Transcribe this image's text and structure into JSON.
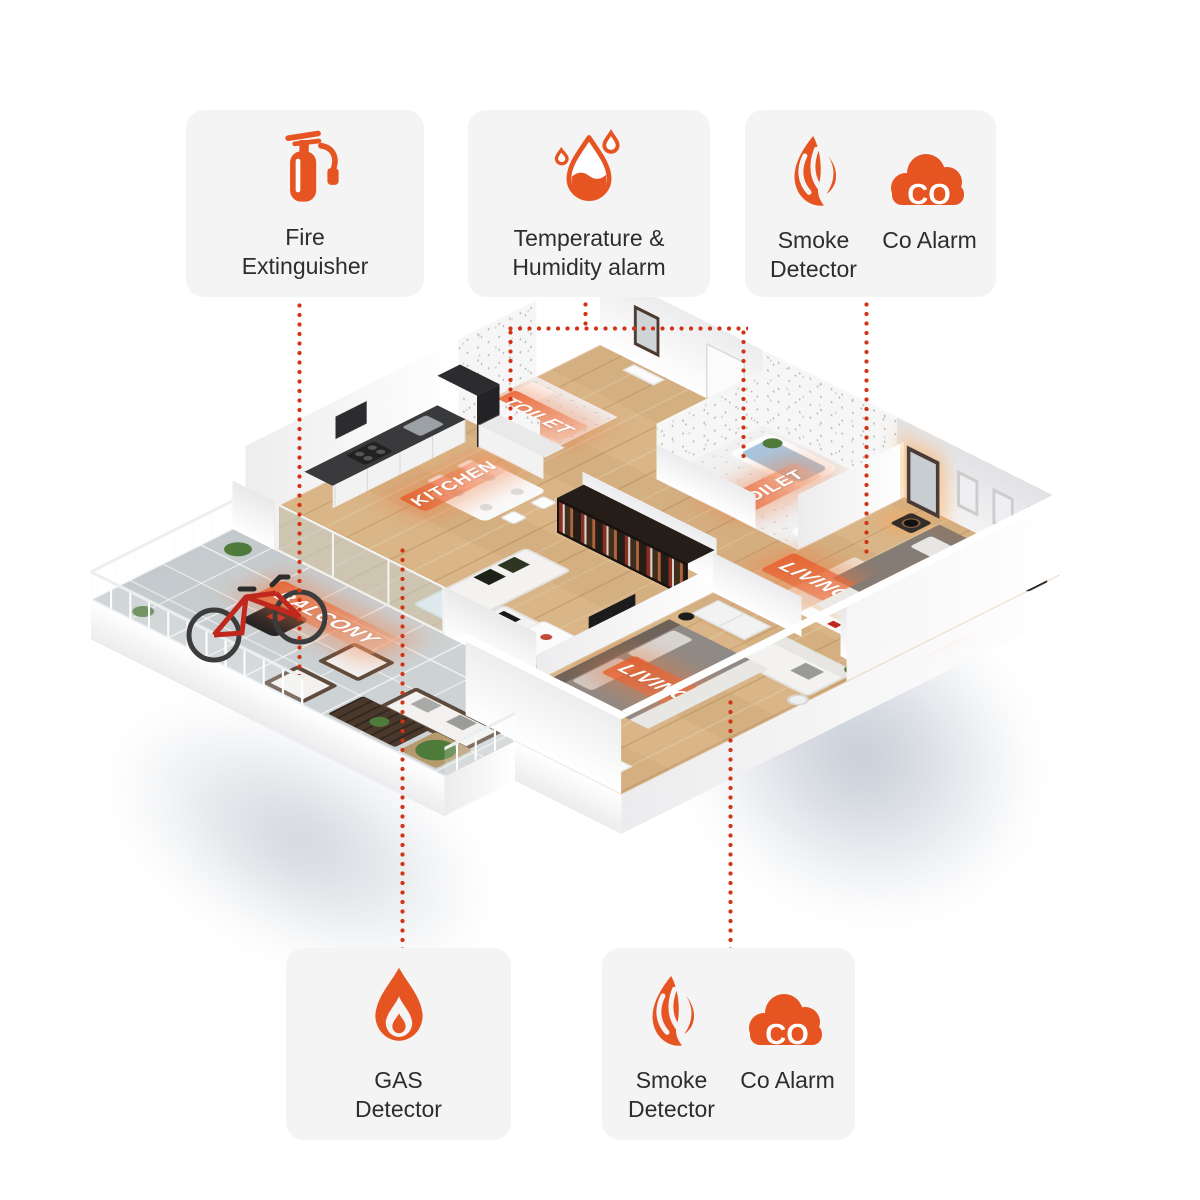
{
  "colors": {
    "accent": "#e65422",
    "dotted_line": "#d03415",
    "card_background": "#f4f4f4",
    "card_text": "#2d2d2d",
    "room_label_text": "#ffffff",
    "room_highlight": "#e8623a",
    "wood_floor": "#d9b587",
    "balcony_tile": "#cdd2d4"
  },
  "cards": {
    "fire": {
      "label": "Fire Extinguisher",
      "icon": "fire-extinguisher-icon"
    },
    "temp_humidity": {
      "label": "Temperature & Humidity alarm",
      "icon": "humidity-drop-icon"
    },
    "smoke_co_top": {
      "smoke_label": "Smoke Detector",
      "smoke_icon": "smoke-icon",
      "co_label": "Co Alarm",
      "co_icon": "co-cloud-icon",
      "co_badge": "CO"
    },
    "gas": {
      "label": "GAS Detector",
      "icon": "gas-flame-icon"
    },
    "smoke_co_bottom": {
      "smoke_label": "Smoke Detector",
      "smoke_icon": "smoke-icon",
      "co_label": "Co Alarm",
      "co_icon": "co-cloud-icon",
      "co_badge": "CO"
    }
  },
  "floorplan": {
    "rooms": {
      "toilet1": {
        "label": "TOILET"
      },
      "kitchen": {
        "label": "KITCHEN"
      },
      "balcony": {
        "label": "BALCONY"
      },
      "toilet2": {
        "label": "TOILET"
      },
      "bedroom1": {
        "label": "LIVING ROOM"
      },
      "bedroom2": {
        "label": "LIVING ROOM"
      }
    }
  }
}
